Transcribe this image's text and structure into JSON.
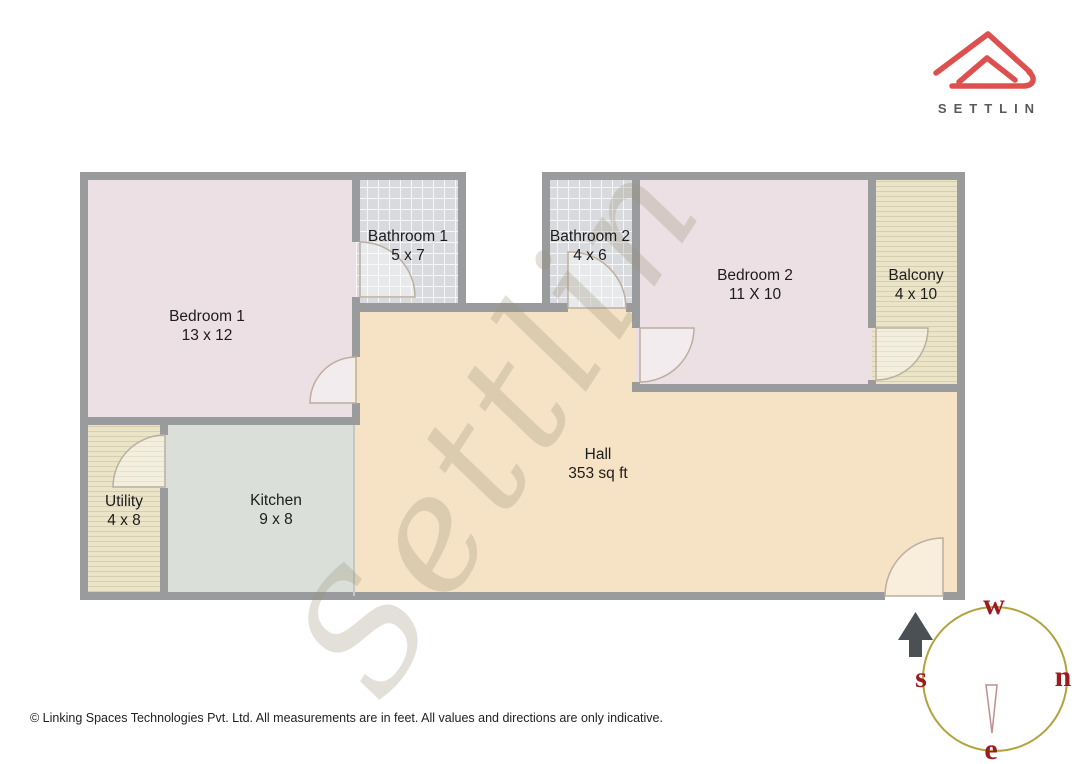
{
  "brand": {
    "name": "SETTLIN"
  },
  "watermark": {
    "text": "Settlin"
  },
  "rooms": [
    {
      "id": "bedroom-1",
      "name": "Bedroom 1",
      "dims": "13 x 12"
    },
    {
      "id": "bathroom-1",
      "name": "Bathroom 1",
      "dims": "5 x 7"
    },
    {
      "id": "bathroom-2",
      "name": "Bathroom 2",
      "dims": "4 x 6"
    },
    {
      "id": "bedroom-2",
      "name": "Bedroom 2",
      "dims": "11 X 10"
    },
    {
      "id": "balcony",
      "name": "Balcony",
      "dims": "4 x 10"
    },
    {
      "id": "utility",
      "name": "Utility",
      "dims": "4 x 8"
    },
    {
      "id": "kitchen",
      "name": "Kitchen",
      "dims": "9 x 8"
    },
    {
      "id": "hall",
      "name": "Hall",
      "dims": "353 sq ft"
    }
  ],
  "compass": {
    "west": "w",
    "north": "n",
    "east": "e",
    "south": "s"
  },
  "footer": {
    "copyright": "© Linking Spaces Technologies Pvt. Ltd. All measurements are in feet. All values and directions are only indicative."
  },
  "colors": {
    "brand_red": "#dd5050",
    "wall_gray": "#9a9b9d",
    "bedroom_fill": "#ece0e4",
    "bathroom_fill": "#d9dade",
    "balcony_utility_fill": "#ebe4c9",
    "kitchen_fill": "#dadfd9",
    "hall_fill": "#f6e3c5",
    "compass_ring": "#b2a33c",
    "compass_letters": "#9b1b1f",
    "label_text": "#1c1c1c"
  }
}
